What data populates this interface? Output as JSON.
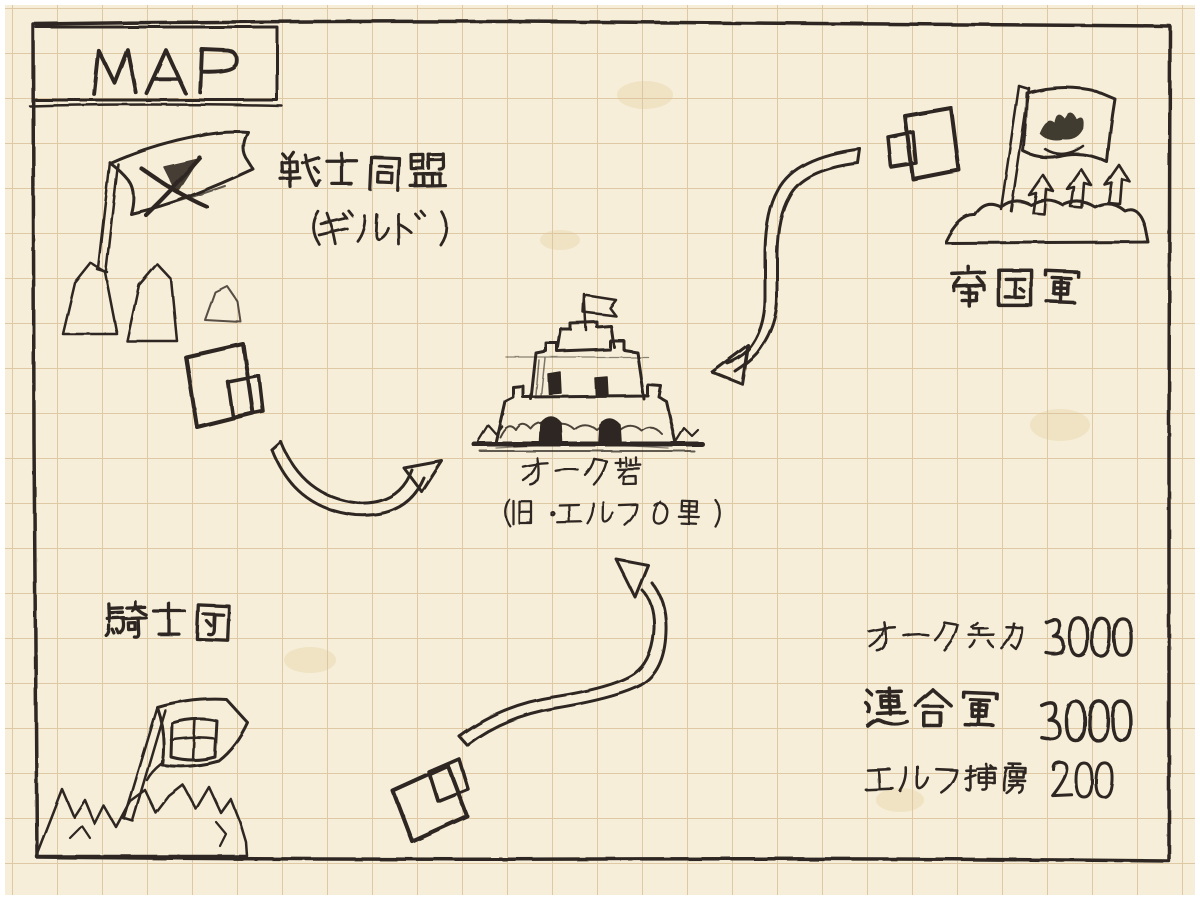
{
  "page": {
    "title": "MAP"
  },
  "factions": {
    "warrior_alliance": {
      "name": "戦士同盟",
      "subtitle": "（ギルド）"
    },
    "imperial_army": {
      "name": "帝国軍"
    },
    "knights_order": {
      "name": "騎士団"
    }
  },
  "fortress": {
    "name": "オーク砦",
    "former_name": "（旧・エルフの里）"
  },
  "stats": [
    {
      "label": "オーク兵力",
      "value": "3000"
    },
    {
      "label": "連合軍",
      "value": "3000"
    },
    {
      "label": "エルフ捕虜",
      "value": "200"
    }
  ],
  "icons": {
    "warrior_alliance_flag": "crossed-swords-flag-icon",
    "imperial_flag": "crown-flag-icon",
    "knights_flag": "grid-emblem-flag-icon",
    "fortress": "tiered-fortress-icon",
    "unit_marker": "block-unit-icon",
    "advance_arrow": "curved-arrow-icon",
    "hill_spears": "up-arrows-icon"
  },
  "colors": {
    "paper": "#f6eed8",
    "grid": "#d9bf97",
    "ink": "#2e2720"
  }
}
